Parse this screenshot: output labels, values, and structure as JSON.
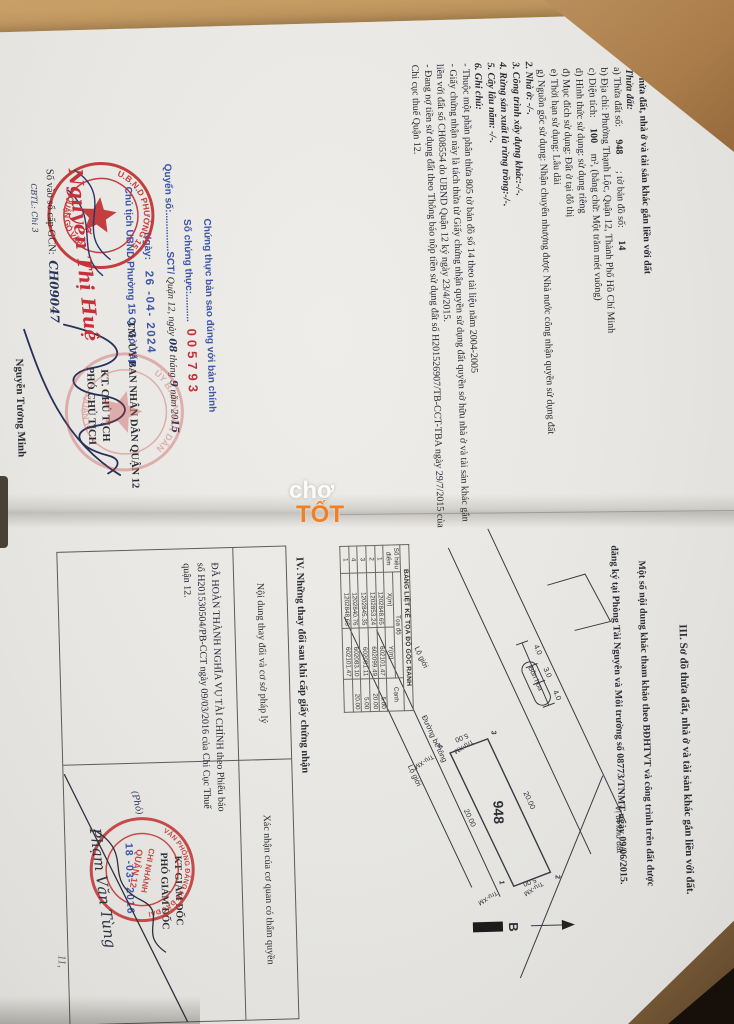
{
  "left_page": {
    "section2": {
      "title": "II. Thửa đất, nhà ở và tài sản khác gắn liền với đất",
      "item1": "1. Thửa đất:",
      "a1": "a) Thửa đất số:",
      "a2": "948",
      "a3": "; tờ bản đồ số:",
      "a4": "14",
      "b": "b) Địa chỉ:  Phường Thạnh Lộc, Quận 12, Thành Phố Hồ Chí Minh",
      "c1": "c) Diện tích:",
      "c2": "100",
      "c3": "m², (bằng chữ: Một trăm mét vuông)",
      "d": "d) Hình thức sử dụng: sử dụng riêng",
      "dd": "đ) Mục đích sử dụng:  Đất ở tại đô thị",
      "e": "e) Thời hạn sử dụng:  Lâu dài",
      "g": "g) Nguồn gốc sử dụng:  Nhận chuyển nhượng được Nhà nước công nhận quyền sử dụng đất",
      "n2": "2. Nhà ở: -/-.",
      "n3": "3. Công trình xây dựng khác:-/-.",
      "n4": "4. Rừng sản xuất là rừng trồng:-/-.",
      "n5": "5. Cây lâu năm: -/-.",
      "n6": "6. Ghi chú:",
      "note1": "- Thuộc một phần phân thửa 805 tờ bản đồ số 14 theo tài liệu năm 2004-2005",
      "note2": "- Giấy chứng nhận này là tách thửa từ Giấy chứng nhận quyền sử dụng đất quyền sở hữu nhà ở và tài sản khác gắn liền với đất số CH08554 do UBND Quận 12 ký ngày 23/4/2015.",
      "note3": "- Đang nợ tiền sử dụng đất theo Thông báo nộp tiền sử dụng đất số H201526907/TB-CCT-TBA ngày 29/7/2015 của Chi cục thuế Quận 12."
    },
    "certify": {
      "line1": "Chứng thực bản sao đúng với bản chính",
      "line2_label": "Số chứng thực:..........",
      "number": "005793",
      "line3_label": "Quyển số:..............SCT/",
      "issue_pre": "Quận 12, ngày",
      "issue_day": "08",
      "issue_thang": "tháng",
      "issue_month": "9",
      "issue_nam": "năm 20",
      "issue_year": "15",
      "date_label": "Ngày:",
      "date_value": "26 -04- 2024",
      "chairman": "Chủ tịch UBND Phường 15 Q. Gò Vấp"
    },
    "committee": {
      "l1": "TM. ỦY BAN NHÂN DÂN QUẬN 12",
      "l2": "KT. CHỦ TỊCH",
      "l3": "PHÓ CHỦ TỊCH",
      "signer": "Nguyễn Tương Minh"
    },
    "red_sign": "Nguyễn Thị Huệ",
    "cbtl": "CBTL: Chi 3",
    "book_label": "Số vào sổ cấp GCN:",
    "book_value": "CH09047",
    "stamp1": {
      "t": "U.B.N.D PHƯỜNG 15",
      "b": "QUẬN GÒ VẤP"
    },
    "stamp2": {
      "t": "ỦY BAN NHÂN DÂN",
      "b": "QUẬN 12"
    }
  },
  "right_page": {
    "s3_title": "III. Sơ đồ thửa đất, nhà ở và tài sản khác gắn liền với đất.",
    "s3_note1": "Một số nội dung khác tham khảo theo BĐHTVT và công trình trên đất được",
    "s3_note2": "đăng ký tại Phòng Tài Nguyên và Môi trường số 08773/TNMT ngày 09/06/2015.",
    "coord": {
      "title": "BẢNG LIỆT KÊ TỌA ĐỘ GÓC RANH",
      "h_point": "Số hiệu điểm",
      "h_toado": "Tọa độ",
      "h_x": "X(m)",
      "h_y": "Y(m)",
      "h_canh": "Cạnh",
      "rows": [
        {
          "n": "1",
          "x": "1202848.65",
          "y": "602101.47",
          "c": "5.00"
        },
        {
          "n": "2",
          "x": "1202853.24",
          "y": "602099.49",
          "c": "20.00"
        },
        {
          "n": "3",
          "x": "1202845.35",
          "y": "602081.11",
          "c": "5.00"
        },
        {
          "n": "4",
          "x": "1202840.76",
          "y": "602083.10",
          "c": "20.00"
        },
        {
          "n": "1",
          "x": "1202848.65",
          "y": "602101.47",
          "c": ""
        }
      ]
    },
    "diagram": {
      "parcel": "948",
      "lo_gioi": "Lộ giới",
      "bon_hoa": "Bồn hoa",
      "duong_bt": "Đường bê tông",
      "d1": "4.0",
      "d2": "3.0",
      "d3": "4.0",
      "s_top": "20.00",
      "s_bottom": "20.00",
      "s_left": "5.00",
      "s_right": "5.00",
      "c1": "1",
      "c2": "2",
      "c3": "3",
      "c4": "4",
      "post": "Trụ-XM",
      "north": "B",
      "loc": "Vị trí khu đất"
    },
    "s4_title": "IV. Những thay đổi sau khi cấp giấy chứng nhận",
    "table": {
      "col1": "Nội dung thay đổi và cơ sở pháp lý",
      "col2": "Xác nhận của cơ quan có thẩm quyền"
    },
    "finance": "ĐÃ HOÀN THÀNH NGHĨA VỤ TÀI CHÍNH theo Phiếu báo số H201530504/PB-CCT ngày 09/03/2016 của Chi Cục Thuế quận 12.",
    "pho": "(Phó)",
    "approve": {
      "l1": "KT GIÁM ĐỐC",
      "l2": "PHÓ GIÁM ĐỐC",
      "date": "18 -03- 2016",
      "signer": "Phạm Văn Tùng"
    },
    "stamp3": {
      "t": "VĂN PHÒNG ĐĂNG KÝ ĐẤT ĐAI",
      "c1": "CHI NHÁNH",
      "c2": "QUẬN 12"
    },
    "page_mark": "11,"
  }
}
